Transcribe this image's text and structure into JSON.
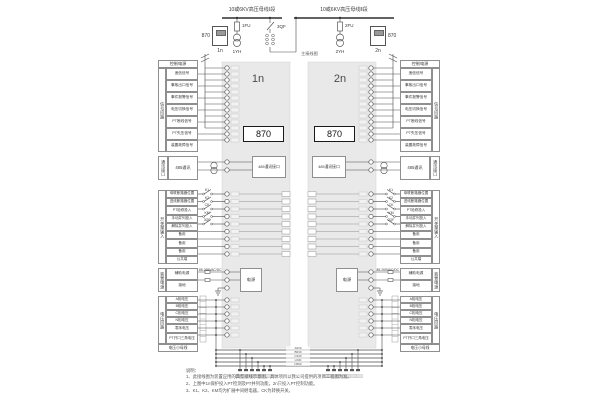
{
  "top": {
    "bus1_label": "10或6KV高压母线Ⅰ段",
    "bus2_label": "10或6KV高压母线Ⅱ段",
    "fuse1": "1FU",
    "fuse2": "2FU",
    "breaker": "3QF",
    "pt1": "1YH",
    "pt2": "2YH",
    "dev1_label": "870",
    "dev1_sub": "1n",
    "dev2_label": "870",
    "dev2_sub": "2n",
    "main_label": "主接线图"
  },
  "panels": {
    "left_title": "1n",
    "right_title": "2n",
    "device_label": "870",
    "comm_box": "485通讯接口",
    "psu_box": "电源"
  },
  "signal": {
    "header": "控制电源",
    "strip": "信号回路",
    "rows": [
      "遥信信号",
      "事故出口信号",
      "事件报警信号",
      "电压切换信号",
      "PT断线信号",
      "PT失压信号",
      "装置故障信号"
    ]
  },
  "comm": {
    "strip": "通讯接口",
    "box": "485通讯"
  },
  "di": {
    "strip": "开关量输入",
    "rows": [
      "母联断路器位置",
      "进线断路器位置",
      "PT检修投入",
      "手动并列投入",
      "解除并列投入",
      "备用",
      "备用",
      "备用",
      "公共端"
    ],
    "contacts": [
      "K1",
      "K2",
      "CK",
      "KM",
      "3QF"
    ]
  },
  "power": {
    "strip": "装置电源",
    "rows": [
      "辅助电源",
      "接地"
    ],
    "range": "85-265VAC/DC"
  },
  "voltage": {
    "strip": "电压回路",
    "rows": [
      "A相电压",
      "B相电压",
      "C相电压",
      "N相电压",
      "零序电压",
      "PT开口三角电压"
    ],
    "bottom": "电压小母线"
  },
  "bus_labels": [
    "A630",
    "B630",
    "C630",
    "L630",
    "N600"
  ],
  "notes": {
    "title": "说明：",
    "items": [
      "1、此接线图为装置应用的典型接线示意图，具体项目以我公司提供的项目工程图为准。",
      "2、上图中1n保护投入PT检测及PT并列功能，2n只投入PT控制功能。",
      "3、K1、K2、KM均为扩展中间继电器，CK为转换开关。"
    ]
  },
  "colors": {
    "panel": "#e9e9e9",
    "wire": "#4a4a4a",
    "bus": "#2f2f2f"
  }
}
